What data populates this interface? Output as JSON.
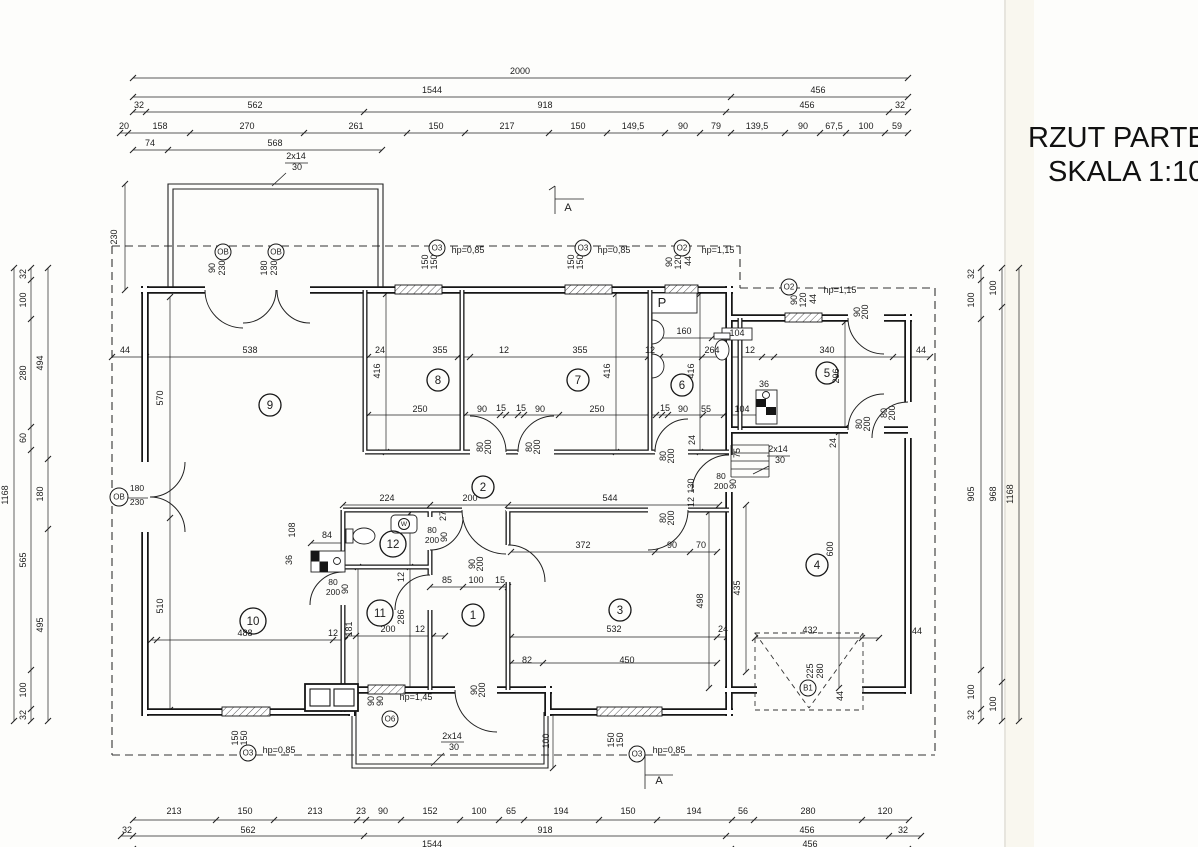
{
  "title": {
    "line1": "RZUT PARTER",
    "line2": "SKALA 1:100"
  },
  "rooms": [
    [
      "1",
      473,
      615
    ],
    [
      "2",
      483,
      487
    ],
    [
      "3",
      620,
      610
    ],
    [
      "4",
      817,
      565
    ],
    [
      "5",
      827,
      373
    ],
    [
      "6",
      682,
      385
    ],
    [
      "7",
      578,
      380
    ],
    [
      "8",
      438,
      380
    ],
    [
      "9",
      270,
      405
    ],
    [
      "10",
      253,
      621
    ],
    [
      "11",
      380,
      613
    ],
    [
      "12",
      393,
      544
    ]
  ],
  "markers": [
    [
      "OB",
      223,
      252,
      8
    ],
    [
      "OB",
      276,
      252,
      8
    ],
    [
      "O3",
      437,
      248,
      8
    ],
    [
      "O3",
      583,
      248,
      8
    ],
    [
      "O2",
      682,
      248,
      8
    ],
    [
      "O2",
      789,
      287,
      8
    ],
    [
      "OB",
      119,
      497,
      9
    ],
    [
      "O3",
      248,
      753,
      8
    ],
    [
      "O6",
      390,
      719,
      8
    ],
    [
      "O3",
      637,
      754,
      8
    ],
    [
      "B1",
      808,
      688,
      8
    ],
    [
      "W",
      404,
      524,
      5.5
    ]
  ],
  "labels": [
    [
      "2000",
      520,
      74
    ],
    [
      "1544",
      432,
      93
    ],
    [
      "456",
      818,
      93
    ],
    [
      "32",
      139,
      108
    ],
    [
      "562",
      255,
      108
    ],
    [
      "918",
      545,
      108
    ],
    [
      "456",
      807,
      108
    ],
    [
      "32",
      900,
      108
    ],
    [
      "20",
      124,
      129
    ],
    [
      "158",
      160,
      129
    ],
    [
      "270",
      247,
      129
    ],
    [
      "261",
      356,
      129
    ],
    [
      "150",
      436,
      129
    ],
    [
      "217",
      507,
      129
    ],
    [
      "150",
      578,
      129
    ],
    [
      "149,5",
      633,
      129
    ],
    [
      "90",
      683,
      129
    ],
    [
      "79",
      716,
      129
    ],
    [
      "139,5",
      757,
      129
    ],
    [
      "90",
      803,
      129
    ],
    [
      "67,5",
      834,
      129
    ],
    [
      "100",
      866,
      129
    ],
    [
      "59",
      897,
      129
    ],
    [
      "74",
      150,
      146
    ],
    [
      "568",
      275,
      146
    ],
    [
      "2x14",
      296,
      159
    ],
    [
      "30",
      297,
      170
    ],
    [
      "230",
      117,
      237,
      1
    ],
    [
      "A",
      568,
      211,
      0,
      11
    ],
    [
      "A",
      659,
      784,
      0,
      11
    ],
    [
      "90",
      215,
      268,
      1
    ],
    [
      "230",
      225,
      268,
      1
    ],
    [
      "180",
      267,
      268,
      1
    ],
    [
      "230",
      277,
      268,
      1
    ],
    [
      "150",
      428,
      262,
      1
    ],
    [
      "150",
      437,
      262,
      1
    ],
    [
      "hp=0,85",
      468,
      253
    ],
    [
      "150",
      574,
      262,
      1
    ],
    [
      "150",
      583,
      262,
      1
    ],
    [
      "hp=0,85",
      614,
      253
    ],
    [
      "90",
      672,
      262,
      1
    ],
    [
      "120",
      681,
      262,
      1
    ],
    [
      "44",
      691,
      261,
      1
    ],
    [
      "hp=1,15",
      718,
      253
    ],
    [
      "90",
      797,
      300,
      1
    ],
    [
      "120",
      806,
      300,
      1
    ],
    [
      "44",
      816,
      299,
      1
    ],
    [
      "hp=1,15",
      840,
      293
    ],
    [
      "213",
      174,
      814
    ],
    [
      "150",
      245,
      814
    ],
    [
      "213",
      315,
      814
    ],
    [
      "23",
      361,
      814
    ],
    [
      "90",
      383,
      814
    ],
    [
      "152",
      430,
      814
    ],
    [
      "100",
      479,
      814
    ],
    [
      "65",
      511,
      814
    ],
    [
      "194",
      561,
      814
    ],
    [
      "150",
      628,
      814
    ],
    [
      "194",
      694,
      814
    ],
    [
      "56",
      743,
      814
    ],
    [
      "280",
      808,
      814
    ],
    [
      "120",
      885,
      814
    ],
    [
      "32",
      127,
      833
    ],
    [
      "562",
      248,
      833
    ],
    [
      "918",
      545,
      833
    ],
    [
      "456",
      807,
      833
    ],
    [
      "32",
      903,
      833
    ],
    [
      "1544",
      432,
      847
    ],
    [
      "456",
      810,
      847
    ],
    [
      "2x14",
      452,
      739
    ],
    [
      "30",
      454,
      750
    ],
    [
      "150",
      238,
      738,
      1
    ],
    [
      "150",
      247,
      738,
      1
    ],
    [
      "hp=0,85",
      279,
      753
    ],
    [
      "150",
      614,
      740,
      1
    ],
    [
      "150",
      623,
      740,
      1
    ],
    [
      "hp=0,85",
      669,
      753
    ],
    [
      "90",
      374,
      701,
      1
    ],
    [
      "90",
      383,
      701,
      1
    ],
    [
      "hp=1,45",
      416,
      700
    ],
    [
      "100",
      549,
      741,
      1
    ],
    [
      "1168",
      8,
      495,
      1
    ],
    [
      "32",
      26,
      274,
      1
    ],
    [
      "100",
      26,
      300,
      1
    ],
    [
      "280",
      26,
      373,
      1
    ],
    [
      "60",
      26,
      438,
      1
    ],
    [
      "565",
      26,
      560,
      1
    ],
    [
      "100",
      26,
      690,
      1
    ],
    [
      "32",
      26,
      715,
      1
    ],
    [
      "494",
      43,
      363,
      1
    ],
    [
      "180",
      43,
      494,
      1
    ],
    [
      "495",
      43,
      625,
      1
    ],
    [
      "180",
      137,
      491,
      0,
      8.5
    ],
    [
      "230",
      137,
      505,
      0,
      8.5
    ],
    [
      "1168",
      1013,
      494,
      1
    ],
    [
      "100",
      996,
      288,
      1
    ],
    [
      "968",
      996,
      494,
      1
    ],
    [
      "100",
      996,
      704,
      1
    ],
    [
      "32",
      974,
      274,
      1
    ],
    [
      "100",
      974,
      300,
      1
    ],
    [
      "905",
      974,
      494,
      1
    ],
    [
      "100",
      974,
      692,
      1
    ],
    [
      "32",
      974,
      715,
      1
    ],
    [
      "44",
      125,
      353
    ],
    [
      "538",
      250,
      353
    ],
    [
      "24",
      380,
      353
    ],
    [
      "355",
      440,
      353
    ],
    [
      "12",
      504,
      353
    ],
    [
      "355",
      580,
      353
    ],
    [
      "12",
      650,
      353
    ],
    [
      "264",
      712,
      353
    ],
    [
      "12",
      750,
      353
    ],
    [
      "340",
      827,
      353
    ],
    [
      "44",
      921,
      353
    ],
    [
      "160",
      684,
      334
    ],
    [
      "104",
      737,
      336
    ],
    [
      "250",
      420,
      412
    ],
    [
      "90",
      482,
      412
    ],
    [
      "15",
      501,
      411
    ],
    [
      "15",
      521,
      411
    ],
    [
      "90",
      540,
      412
    ],
    [
      "250",
      597,
      412
    ],
    [
      "15",
      665,
      411
    ],
    [
      "90",
      683,
      412
    ],
    [
      "55",
      706,
      412
    ],
    [
      "104",
      742,
      412
    ],
    [
      "570",
      163,
      398,
      1
    ],
    [
      "510",
      163,
      606,
      1
    ],
    [
      "416",
      380,
      371,
      1
    ],
    [
      "416",
      610,
      371,
      1
    ],
    [
      "416",
      694,
      371,
      1
    ],
    [
      "296",
      839,
      376,
      1
    ],
    [
      "600",
      833,
      549,
      1
    ],
    [
      "435",
      740,
      588,
      1
    ],
    [
      "498",
      703,
      601,
      1
    ],
    [
      "286",
      404,
      617,
      1
    ],
    [
      "12",
      404,
      577,
      1
    ],
    [
      "181",
      352,
      629,
      1
    ],
    [
      "108",
      295,
      530,
      1
    ],
    [
      "36",
      292,
      560,
      1
    ],
    [
      "24",
      695,
      440,
      1
    ],
    [
      "75",
      740,
      453,
      1
    ],
    [
      "130",
      694,
      486,
      1
    ],
    [
      "12",
      694,
      502,
      1
    ],
    [
      "24",
      836,
      443,
      1
    ],
    [
      "44",
      843,
      696,
      1
    ],
    [
      "225",
      813,
      671,
      1
    ],
    [
      "280",
      823,
      671,
      1
    ],
    [
      "224",
      387,
      501
    ],
    [
      "200",
      470,
      501
    ],
    [
      "544",
      610,
      501
    ],
    [
      "27",
      446,
      516,
      1
    ],
    [
      "85",
      447,
      583
    ],
    [
      "100",
      476,
      583
    ],
    [
      "15",
      500,
      583
    ],
    [
      "80",
      432,
      533,
      0,
      8.5
    ],
    [
      "200",
      432,
      543,
      0,
      8.5
    ],
    [
      "90",
      447,
      537,
      1
    ],
    [
      "80",
      333,
      585,
      0,
      8.5
    ],
    [
      "200",
      333,
      595,
      0,
      8.5
    ],
    [
      "90",
      348,
      589,
      1
    ],
    [
      "372",
      583,
      548
    ],
    [
      "90",
      672,
      548
    ],
    [
      "70",
      701,
      548
    ],
    [
      "532",
      614,
      632
    ],
    [
      "24",
      723,
      632
    ],
    [
      "82",
      527,
      663
    ],
    [
      "450",
      627,
      663
    ],
    [
      "488",
      245,
      636
    ],
    [
      "12",
      333,
      636
    ],
    [
      "200",
      388,
      632
    ],
    [
      "12",
      420,
      632
    ],
    [
      "432",
      810,
      633
    ],
    [
      "44",
      917,
      634
    ],
    [
      "2x14",
      778,
      452
    ],
    [
      "30",
      780,
      463
    ],
    [
      "36",
      764,
      387
    ],
    [
      "84",
      327,
      538
    ],
    [
      "80",
      483,
      447,
      1
    ],
    [
      "200",
      491,
      447,
      1
    ],
    [
      "80",
      532,
      447,
      1
    ],
    [
      "200",
      540,
      447,
      1
    ],
    [
      "80",
      666,
      456,
      1
    ],
    [
      "200",
      674,
      456,
      1
    ],
    [
      "80",
      666,
      518,
      1
    ],
    [
      "200",
      674,
      518,
      1
    ],
    [
      "80",
      721,
      479,
      0,
      8.5
    ],
    [
      "200",
      721,
      489,
      0,
      8.5
    ],
    [
      "90",
      736,
      484,
      1
    ],
    [
      "90",
      475,
      564,
      1
    ],
    [
      "200",
      483,
      564,
      1
    ],
    [
      "90",
      477,
      690,
      1
    ],
    [
      "200",
      485,
      690,
      1
    ],
    [
      "90",
      860,
      312,
      1
    ],
    [
      "200",
      868,
      312,
      1
    ],
    [
      "80",
      862,
      424,
      1
    ],
    [
      "200",
      870,
      424,
      1
    ],
    [
      "80",
      887,
      413,
      1
    ],
    [
      "200",
      895,
      413,
      1
    ],
    [
      "P",
      662,
      307,
      0,
      13
    ]
  ],
  "colors": {
    "ink": "#1c1c1c",
    "paper": "#fdfdfb",
    "scan_strip": "#f4f0df"
  }
}
